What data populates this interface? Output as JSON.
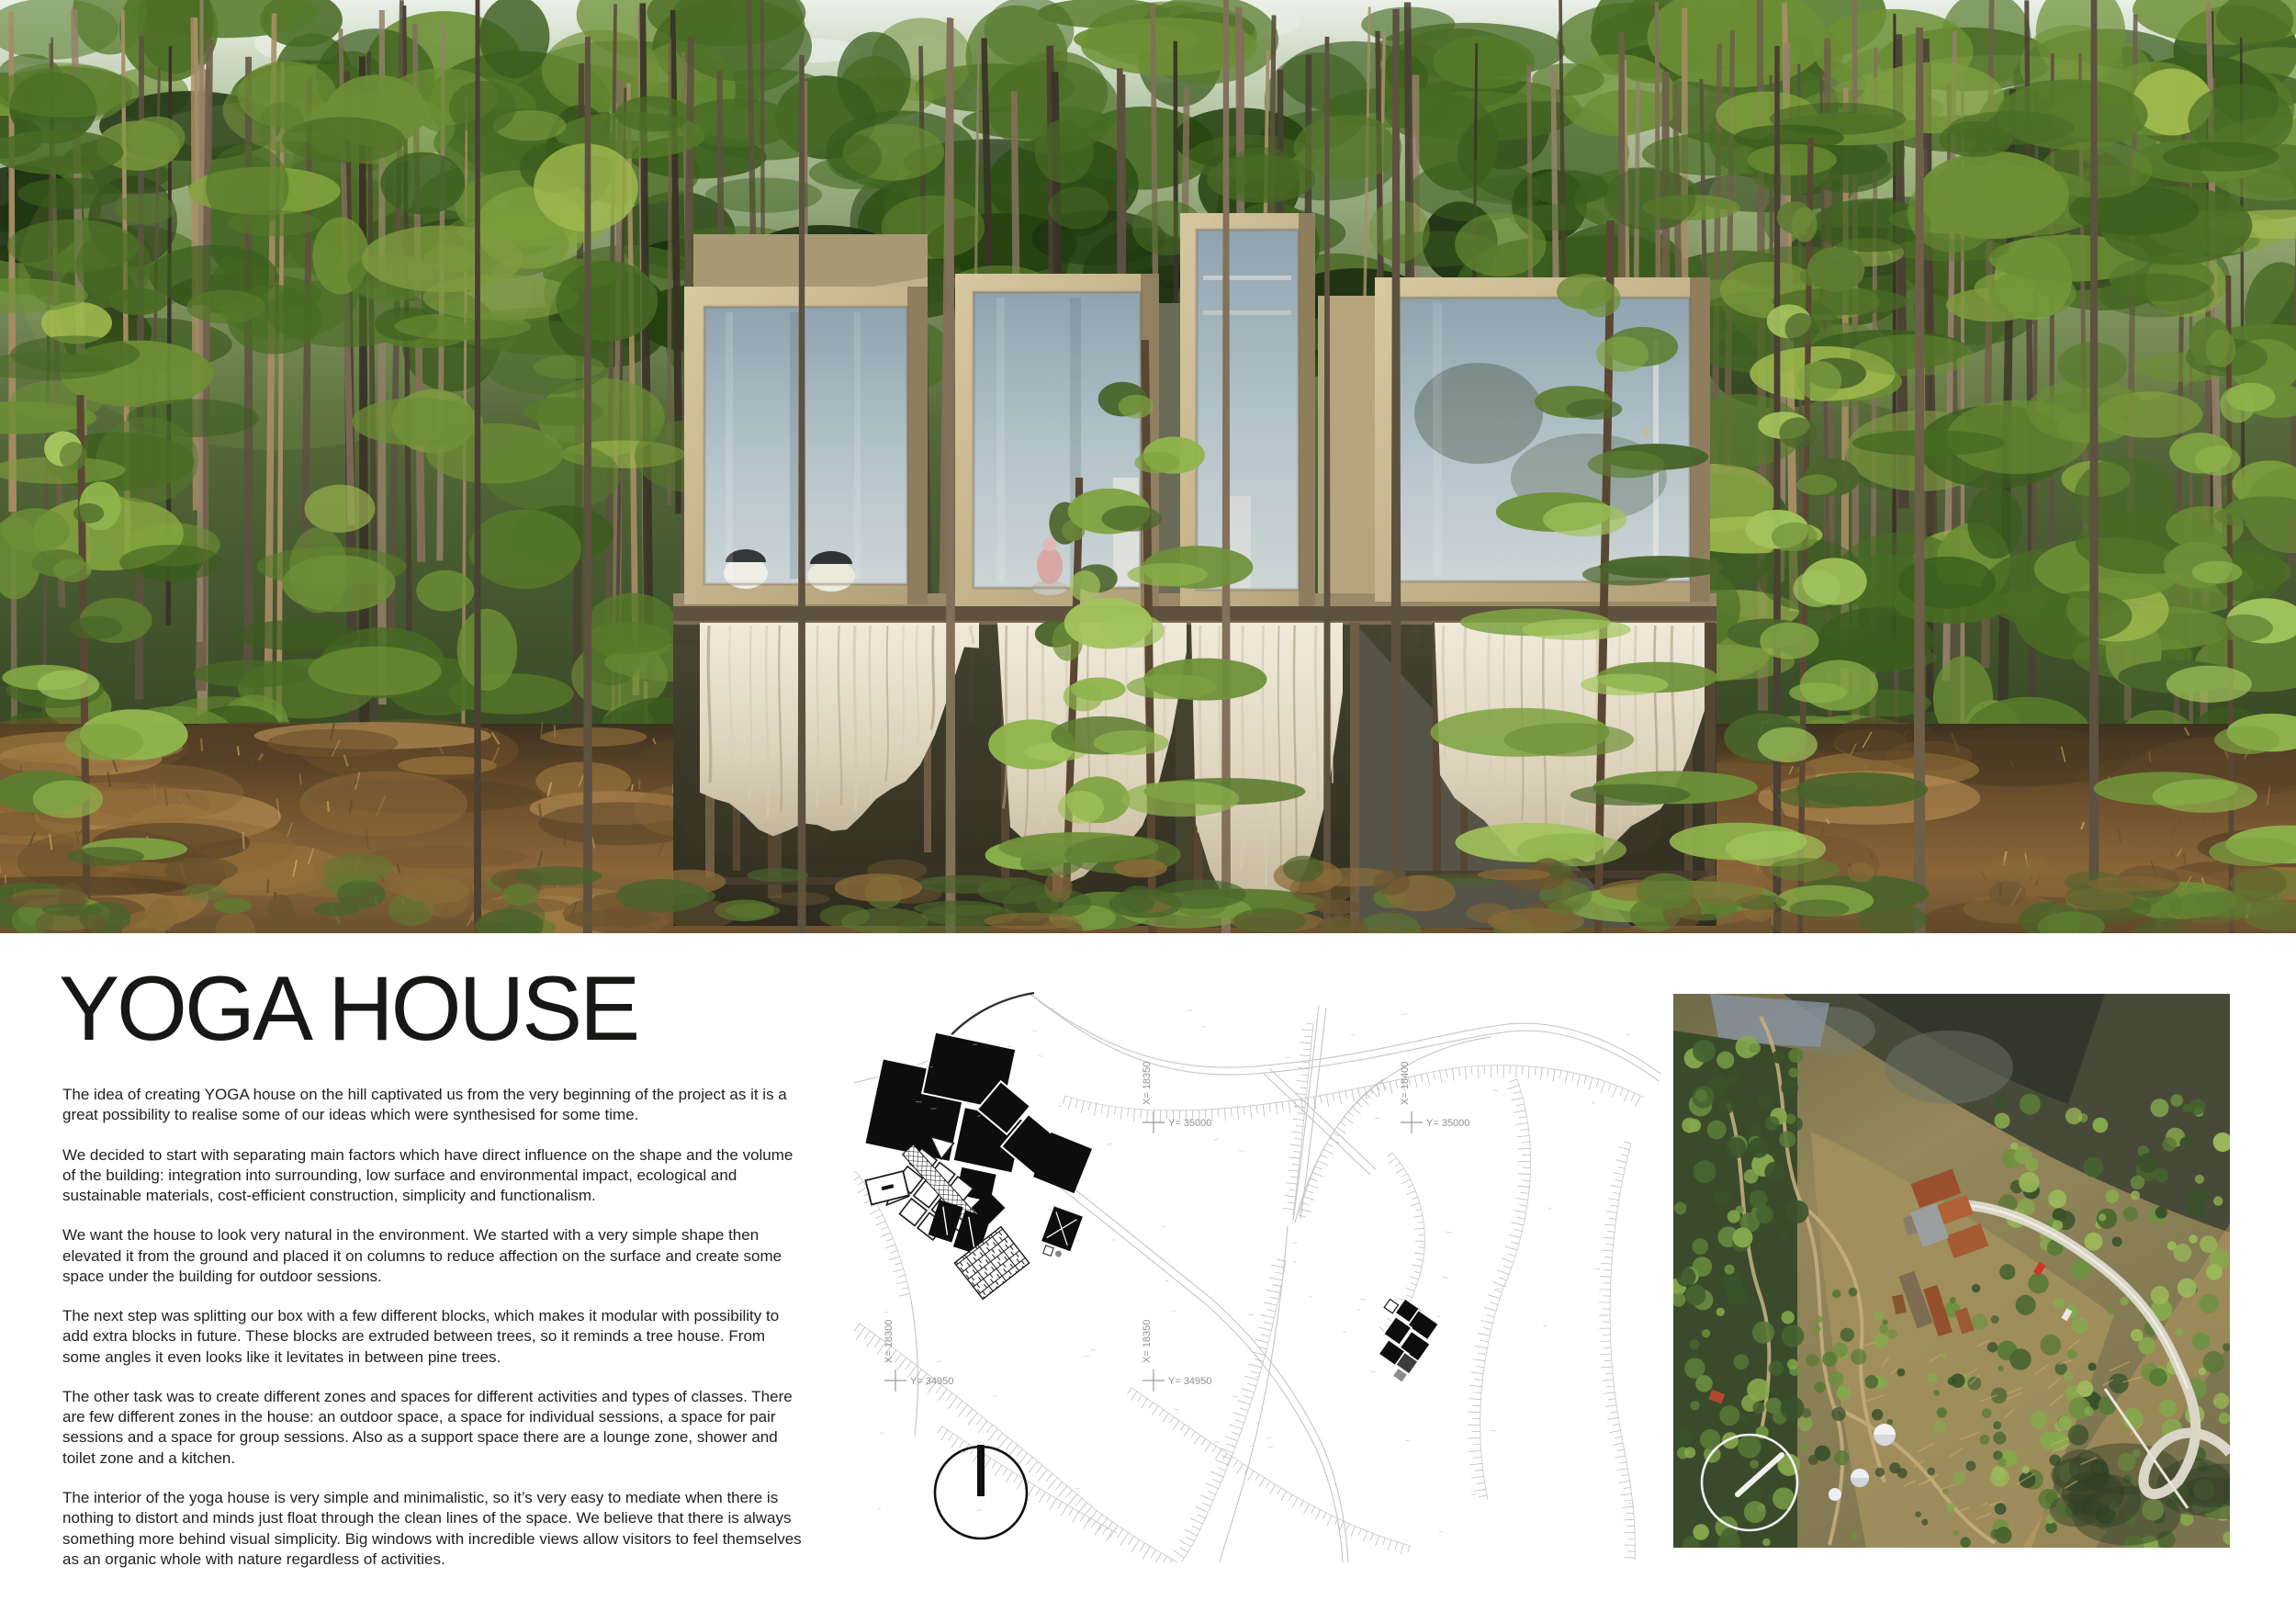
{
  "header": {
    "title": "YOGA HOUSE"
  },
  "description": {
    "paragraphs": [
      "The idea of creating YOGA house on the hill captivated us from the very beginning of the project as it is a great possibility to realise some of our ideas which were synthesised for some time.",
      "We decided to start with separating main factors which have direct influence on the shape and the volume of the building: integration into surrounding, low surface and environmental impact, ecological and sustainable materials, cost-efficient construction, simplicity and functionalism.",
      "We want the house to look very natural in the environment. We started with a very simple shape then elevated it from the ground and placed it on columns to reduce affection on the surface and create some space under the building for outdoor sessions.",
      "The next step was splitting our box with a few different blocks, which makes it modular with possibility to add extra blocks in future. These blocks are extruded between trees, so it reminds a tree house. From some angles it even looks like it levitates in between pine trees.",
      "The other task was to create different zones and spaces for different activities and types of classes. There are few different zones in the house: an outdoor space, a space for individual sessions, a space for pair sessions and a space for group sessions. Also as a support space there are a lounge zone, shower and toilet zone and a kitchen.",
      "The interior of the yoga house is very simple and minimalistic, so it’s very easy to mediate when there is nothing to distort and minds just float through the clean lines of the space. We believe that there is always something more behind visual simplicity. Big windows with incredible views allow visitors to feel themselves as an organic whole with nature regardless of activities."
    ]
  },
  "site_plan": {
    "coordinate_marks": [
      {
        "x_label": "X= 18350",
        "y_label": "Y= 35000"
      },
      {
        "x_label": "X= 18400",
        "y_label": "Y= 35000"
      },
      {
        "x_label": "X= 18300",
        "y_label": "Y= 34950"
      },
      {
        "x_label": "X= 18350",
        "y_label": "Y= 34950"
      }
    ],
    "north_indicator": "north-arrow-circle"
  },
  "aerial_photo": {
    "compass": "compass-circle"
  },
  "palette": {
    "text": "#1f1f1e",
    "forest_dark": "#263a18",
    "forest_mid": "#3c5423",
    "forest_light": "#86a64a",
    "sky": "#e9f0e8",
    "wood_frame": "#c7b68e",
    "glass": "#a9bcc6",
    "curtain": "#e8e0cc",
    "ground": "#7c5c33",
    "plan_line": "#c4c4c4",
    "plan_black": "#111111",
    "aerial_terrain": "#8a7c52",
    "roof_red": "#a85531",
    "road_light": "#d9d6c8"
  }
}
